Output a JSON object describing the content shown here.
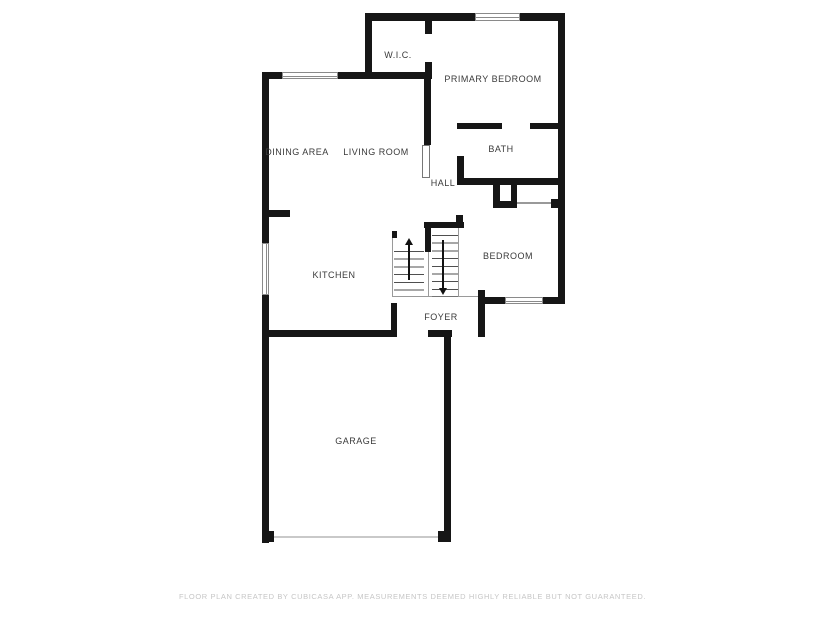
{
  "plan": {
    "title": "Floor plan",
    "rooms": [
      {
        "id": "wic",
        "label": "W.I.C."
      },
      {
        "id": "primary-bedroom",
        "label": "PRIMARY BEDROOM"
      },
      {
        "id": "dining-area",
        "label": "DINING AREA"
      },
      {
        "id": "living-room",
        "label": "LIVING ROOM"
      },
      {
        "id": "bath",
        "label": "BATH"
      },
      {
        "id": "hall",
        "label": "HALL"
      },
      {
        "id": "kitchen",
        "label": "KITCHEN"
      },
      {
        "id": "bedroom",
        "label": "BEDROOM"
      },
      {
        "id": "foyer",
        "label": "FOYER"
      },
      {
        "id": "garage",
        "label": "GARAGE"
      }
    ],
    "stairs": {
      "up_arrow_icon": "stairs-up-arrow",
      "down_arrow_icon": "stairs-down-arrow"
    },
    "features": {
      "windows": 4,
      "garage_door": "opening with threshold line at bottom of garage",
      "front_door": "opening in foyer south wall"
    },
    "colors": {
      "wall": "#161616",
      "background": "#ffffff",
      "room_label": "#3a3a3a",
      "footer": "#c6c6c6",
      "window_border": "#8a8a8a",
      "stair_lines": "#9a9a9a",
      "garage_door_line": "#c9c9c9"
    }
  },
  "footer": {
    "disclaimer": "FLOOR PLAN CREATED BY CUBICASA APP. MEASUREMENTS DEEMED HIGHLY RELIABLE BUT NOT GUARANTEED."
  }
}
